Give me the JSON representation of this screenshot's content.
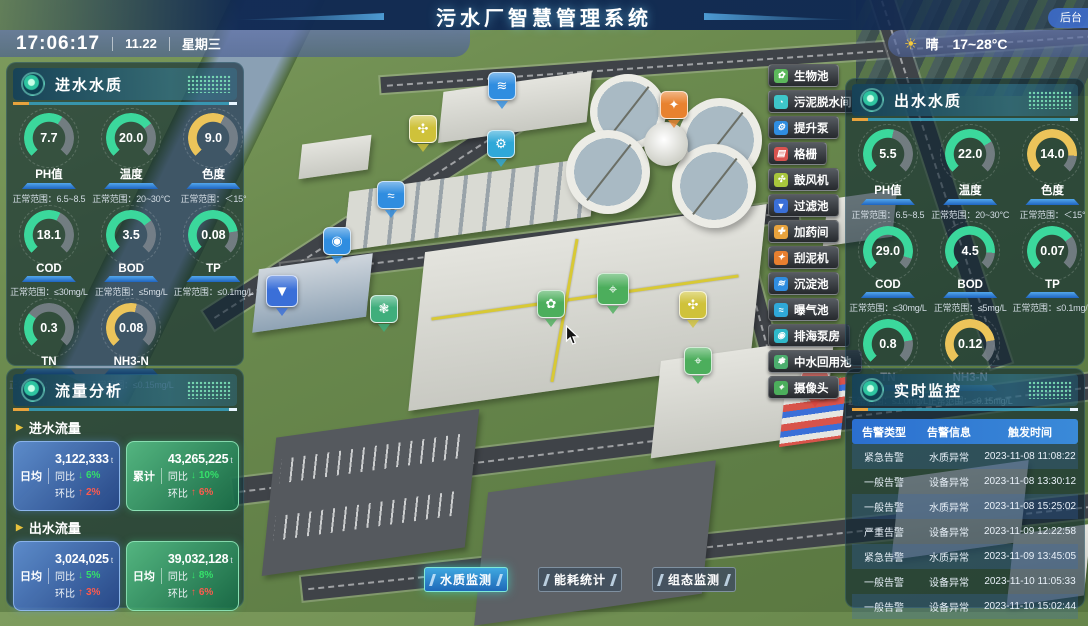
{
  "header": {
    "title": "污水厂智慧管理系统",
    "backend_label": "后台",
    "clock": {
      "time": "17:06:17",
      "date": "11.22",
      "weekday": "星期三"
    },
    "weather": {
      "glyph": "☀",
      "condition": "晴",
      "range": "17~28°C"
    }
  },
  "inflow_quality": {
    "title": "进水水质",
    "gauges": [
      {
        "label": "PH值",
        "value": "7.7",
        "range": "正常范围：6.5~8.5",
        "color": "#3bd89c",
        "fill": 0.62
      },
      {
        "label": "温度",
        "value": "20.0",
        "range": "正常范围：20~30°C",
        "color": "#3bd89c",
        "fill": 0.7
      },
      {
        "label": "色度",
        "value": "9.0",
        "range": "正常范围：＜15°",
        "color": "#ecc45a",
        "fill": 0.6
      },
      {
        "label": "COD",
        "value": "18.1",
        "range": "正常范围：≤30mg/L",
        "color": "#3bd89c",
        "fill": 0.6
      },
      {
        "label": "BOD",
        "value": "3.5",
        "range": "正常范围：≤5mg/L",
        "color": "#3bd89c",
        "fill": 0.7
      },
      {
        "label": "TP",
        "value": "0.08",
        "range": "正常范围：≤0.1mg/L",
        "color": "#3bd89c",
        "fill": 0.8
      },
      {
        "label": "TN",
        "value": "0.3",
        "range": "正常范围：≤1.0mg/L",
        "color": "#3bd89c",
        "fill": 0.3
      },
      {
        "label": "NH3-N",
        "value": "0.08",
        "range": "正常范围：≤0.15mg/L",
        "color": "#ecc45a",
        "fill": 0.55
      }
    ]
  },
  "outflow_quality": {
    "title": "出水水质",
    "gauges": [
      {
        "label": "PH值",
        "value": "5.5",
        "range": "正常范围：6.5~8.5",
        "color": "#3bd89c",
        "fill": 0.55
      },
      {
        "label": "温度",
        "value": "22.0",
        "range": "正常范围：20~30°C",
        "color": "#3bd89c",
        "fill": 0.72
      },
      {
        "label": "色度",
        "value": "14.0",
        "range": "正常范围：＜15°",
        "color": "#ecc45a",
        "fill": 0.85
      },
      {
        "label": "COD",
        "value": "29.0",
        "range": "正常范围：≤30mg/L",
        "color": "#3bd89c",
        "fill": 0.9
      },
      {
        "label": "BOD",
        "value": "4.5",
        "range": "正常范围：≤5mg/L",
        "color": "#3bd89c",
        "fill": 0.85
      },
      {
        "label": "TP",
        "value": "0.07",
        "range": "正常范围：≤0.1mg/L",
        "color": "#3bd89c",
        "fill": 0.7
      },
      {
        "label": "TN",
        "value": "0.8",
        "range": "正常范围：≤1.0mg/L",
        "color": "#3bd89c",
        "fill": 0.8
      },
      {
        "label": "NH3-N",
        "value": "0.12",
        "range": "正常范围：≤0.15mg/L",
        "color": "#ecc45a",
        "fill": 0.8
      }
    ]
  },
  "flow_analysis": {
    "title": "流量分析",
    "sections": [
      {
        "label": "进水流量",
        "cards": [
          {
            "theme": "blue",
            "stat": "日均",
            "value": "3,122,333",
            "unit": "t",
            "rows": [
              {
                "label": "同比",
                "arrow": "↓",
                "dir": "down",
                "pct": "6%"
              },
              {
                "label": "环比",
                "arrow": "↑",
                "dir": "up",
                "pct": "2%"
              }
            ]
          },
          {
            "theme": "green",
            "stat": "累计",
            "value": "43,265,225",
            "unit": "t",
            "rows": [
              {
                "label": "同比",
                "arrow": "↓",
                "dir": "down",
                "pct": "10%"
              },
              {
                "label": "环比",
                "arrow": "↑",
                "dir": "up",
                "pct": "6%"
              }
            ]
          }
        ]
      },
      {
        "label": "出水流量",
        "cards": [
          {
            "theme": "blue",
            "stat": "日均",
            "value": "3,024,025",
            "unit": "t",
            "rows": [
              {
                "label": "同比",
                "arrow": "↓",
                "dir": "down",
                "pct": "5%"
              },
              {
                "label": "环比",
                "arrow": "↑",
                "dir": "up",
                "pct": "3%"
              }
            ]
          },
          {
            "theme": "green",
            "stat": "日均",
            "value": "39,032,128",
            "unit": "t",
            "rows": [
              {
                "label": "同比",
                "arrow": "↓",
                "dir": "down",
                "pct": "8%"
              },
              {
                "label": "环比",
                "arrow": "↑",
                "dir": "up",
                "pct": "6%"
              }
            ]
          }
        ]
      }
    ]
  },
  "monitor": {
    "title": "实时监控",
    "columns": [
      "告警类型",
      "告警信息",
      "触发时间"
    ],
    "rows": [
      [
        "紧急告警",
        "水质异常",
        "2023-11-08 11:08:22"
      ],
      [
        "一般告警",
        "设备异常",
        "2023-11-08 13:30:12"
      ],
      [
        "一般告警",
        "水质异常",
        "2023-11-08 15:25:02"
      ],
      [
        "严重告警",
        "设备异常",
        "2023-11-09 12:22:58"
      ],
      [
        "紧急告警",
        "水质异常",
        "2023-11-09 13:45:05"
      ],
      [
        "一般告警",
        "设备异常",
        "2023-11-10 11:05:33"
      ],
      [
        "一般告警",
        "设备异常",
        "2023-11-10 15:02:44"
      ]
    ]
  },
  "facilities": [
    {
      "label": "生物池",
      "color": "#5cb85c",
      "glyph": "✿"
    },
    {
      "label": "污泥脱水间",
      "color": "#3ec6c9",
      "glyph": "◔"
    },
    {
      "label": "提升泵",
      "color": "#2f8de0",
      "glyph": "⚙"
    },
    {
      "label": "格栅",
      "color": "#d9534f",
      "glyph": "▤"
    },
    {
      "label": "鼓风机",
      "color": "#a8c63c",
      "glyph": "✣"
    },
    {
      "label": "过滤池",
      "color": "#3a6fd8",
      "glyph": "▼"
    },
    {
      "label": "加药间",
      "color": "#e8a33d",
      "glyph": "✚"
    },
    {
      "label": "刮泥机",
      "color": "#e87f2f",
      "glyph": "✦"
    },
    {
      "label": "沉淀池",
      "color": "#2f8de0",
      "glyph": "≋"
    },
    {
      "label": "曝气池",
      "color": "#2fa8d8",
      "glyph": "≈"
    },
    {
      "label": "排海泵房",
      "color": "#2fb8c9",
      "glyph": "◉"
    },
    {
      "label": "中水回用池",
      "color": "#4cae6e",
      "glyph": "❃"
    },
    {
      "label": "摄像头",
      "color": "#4cae5c",
      "glyph": "⌖"
    }
  ],
  "map": {
    "markers": [
      {
        "name": "settling-pool",
        "color": "#2f8de0",
        "glyph": "≋"
      },
      {
        "name": "mud-scraper",
        "color": "#e8822f",
        "glyph": "✦"
      },
      {
        "name": "blower",
        "color": "#cfc23a",
        "glyph": "✣"
      },
      {
        "name": "lift-pump",
        "color": "#2fa8d8",
        "glyph": "⚙"
      },
      {
        "name": "aeration-pool",
        "color": "#2f8de0",
        "glyph": "≈"
      },
      {
        "name": "pump-house",
        "color": "#2f8de0",
        "glyph": "◉"
      },
      {
        "name": "filter-pool",
        "color": "#3a6fd8",
        "glyph": "▼"
      },
      {
        "name": "water-reuse",
        "color": "#3fae7c",
        "glyph": "❃"
      },
      {
        "name": "camera-1",
        "color": "#4cae5c",
        "glyph": "⌖"
      },
      {
        "name": "bio-pool",
        "color": "#4cae5c",
        "glyph": "✿"
      },
      {
        "name": "blower-2",
        "color": "#cfc23a",
        "glyph": "✣"
      },
      {
        "name": "camera-2",
        "color": "#4cae5c",
        "glyph": "⌖"
      },
      {
        "name": "alarm-device",
        "color": "#d8453c",
        "glyph": "✦"
      }
    ]
  },
  "tabs": [
    {
      "label": "水质监测"
    },
    {
      "label": "能耗统计"
    },
    {
      "label": "组态监测"
    }
  ]
}
